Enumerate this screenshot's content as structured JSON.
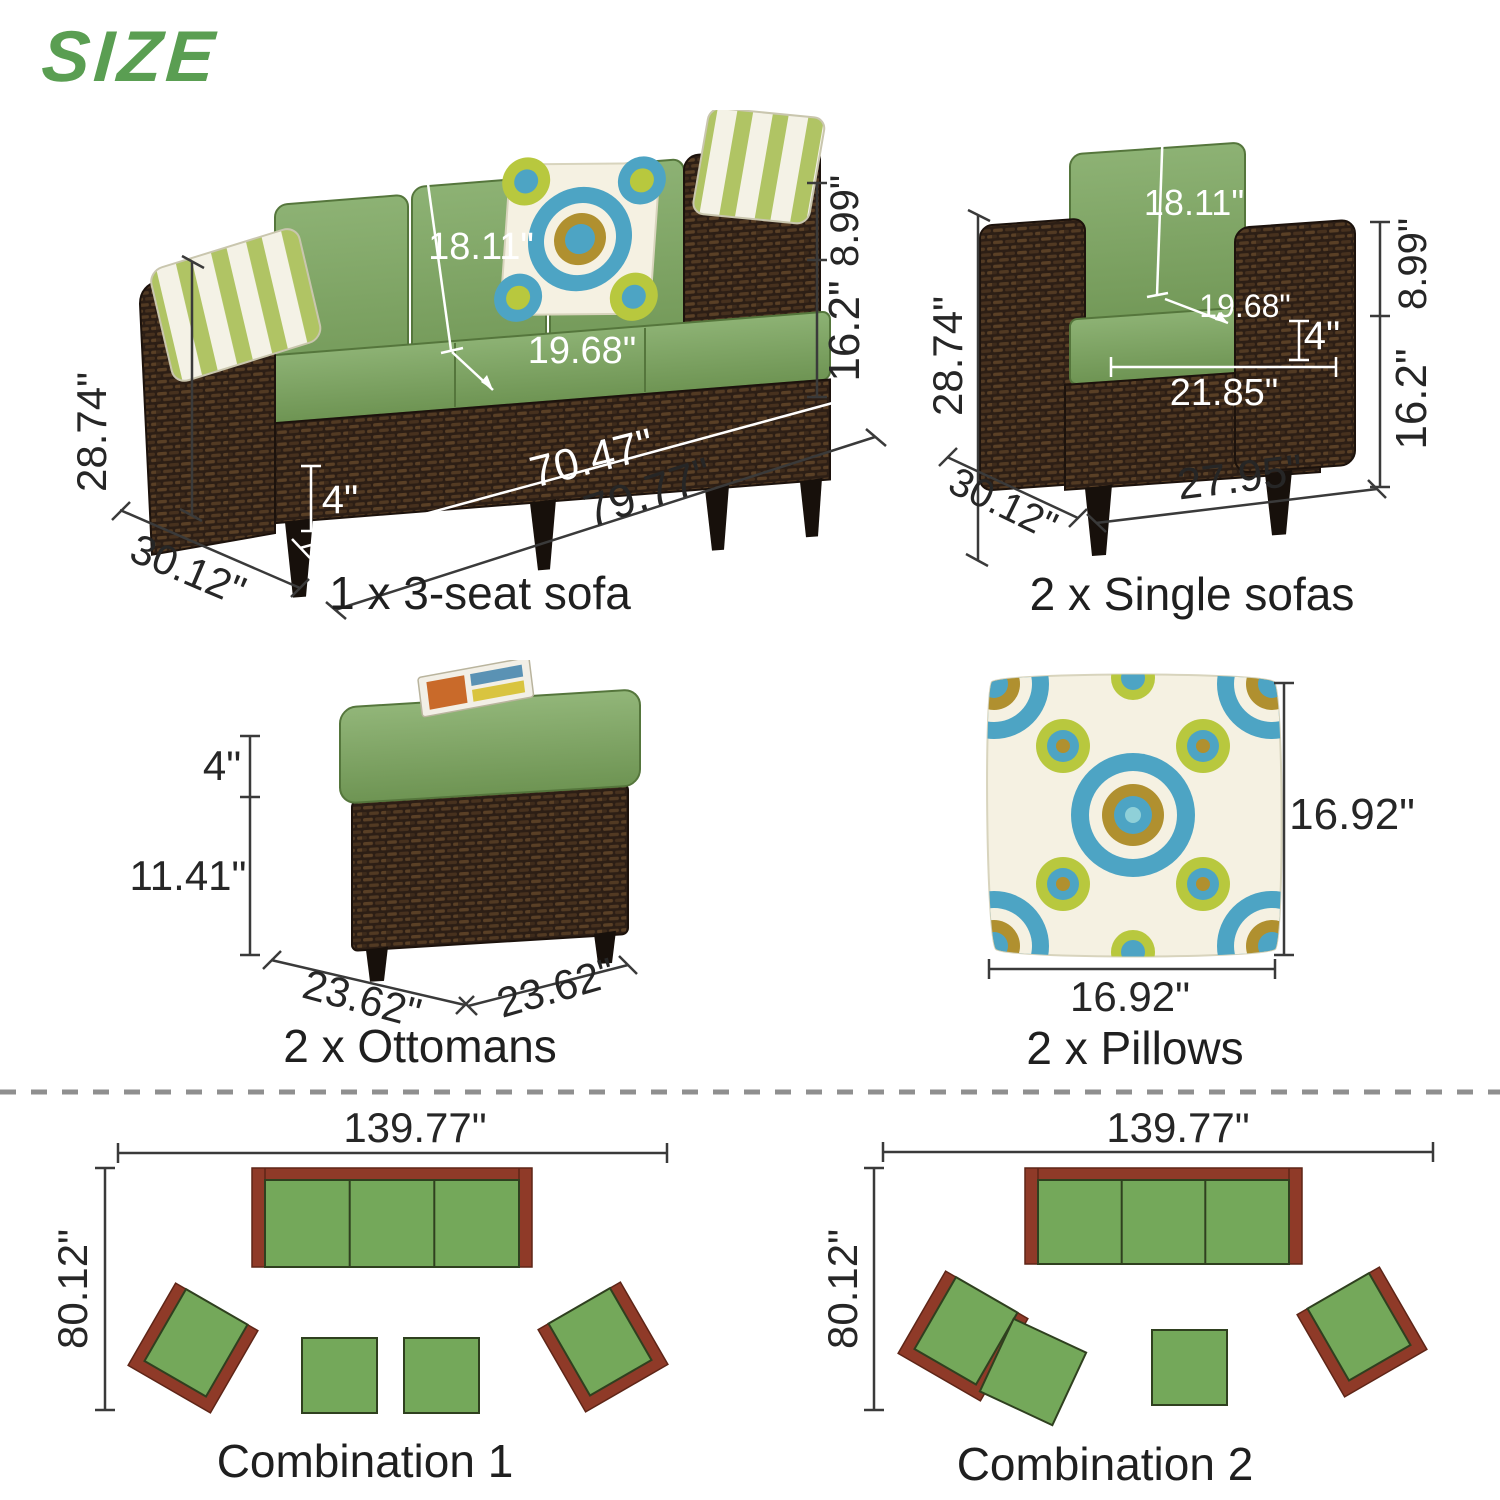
{
  "title": "SIZE",
  "colors": {
    "title_green": "#5a9e52",
    "cushion_green": "#7ca261",
    "wicker_brown": "#2c1e15",
    "plan_red": "#8f3a28",
    "plan_green": "#74a85a",
    "dimension_text": "#262626",
    "divider_gray": "#8f8f8f"
  },
  "sofa": {
    "caption": "1 x 3-seat sofa",
    "dim_height": "28.74\"",
    "dim_depth": "30.12\"",
    "dim_width": "79.77\"",
    "dim_inner_width": "70.47\"",
    "dim_cushion_thickness": "4\"",
    "dim_back_cushion": "18.11\"",
    "dim_seat_depth": "19.68\"",
    "dim_arm_drop": "8.99\"",
    "dim_seat_height": "16.2\""
  },
  "single_sofa": {
    "caption": "2 x Single sofas",
    "dim_height": "28.74\"",
    "dim_depth": "30.12\"",
    "dim_width": "27.95\"",
    "dim_inner_width": "21.85\"",
    "dim_cushion_thickness": "4\"",
    "dim_back_cushion": "18.11\"",
    "dim_seat_depth": "19.68\"",
    "dim_arm_drop": "8.99\"",
    "dim_seat_height": "16.2\""
  },
  "ottoman": {
    "caption": "2 x Ottomans",
    "dim_cushion_thickness": "4\"",
    "dim_base_height": "11.41\"",
    "dim_width": "23.62\"",
    "dim_depth": "23.62\""
  },
  "pillow": {
    "caption": "2 x Pillows",
    "dim_height": "16.92\"",
    "dim_width": "16.92\""
  },
  "combination1": {
    "caption": "Combination 1",
    "dim_width": "139.77\"",
    "dim_depth": "80.12\""
  },
  "combination2": {
    "caption": "Combination 2",
    "dim_width": "139.77\"",
    "dim_depth": "80.12\""
  }
}
